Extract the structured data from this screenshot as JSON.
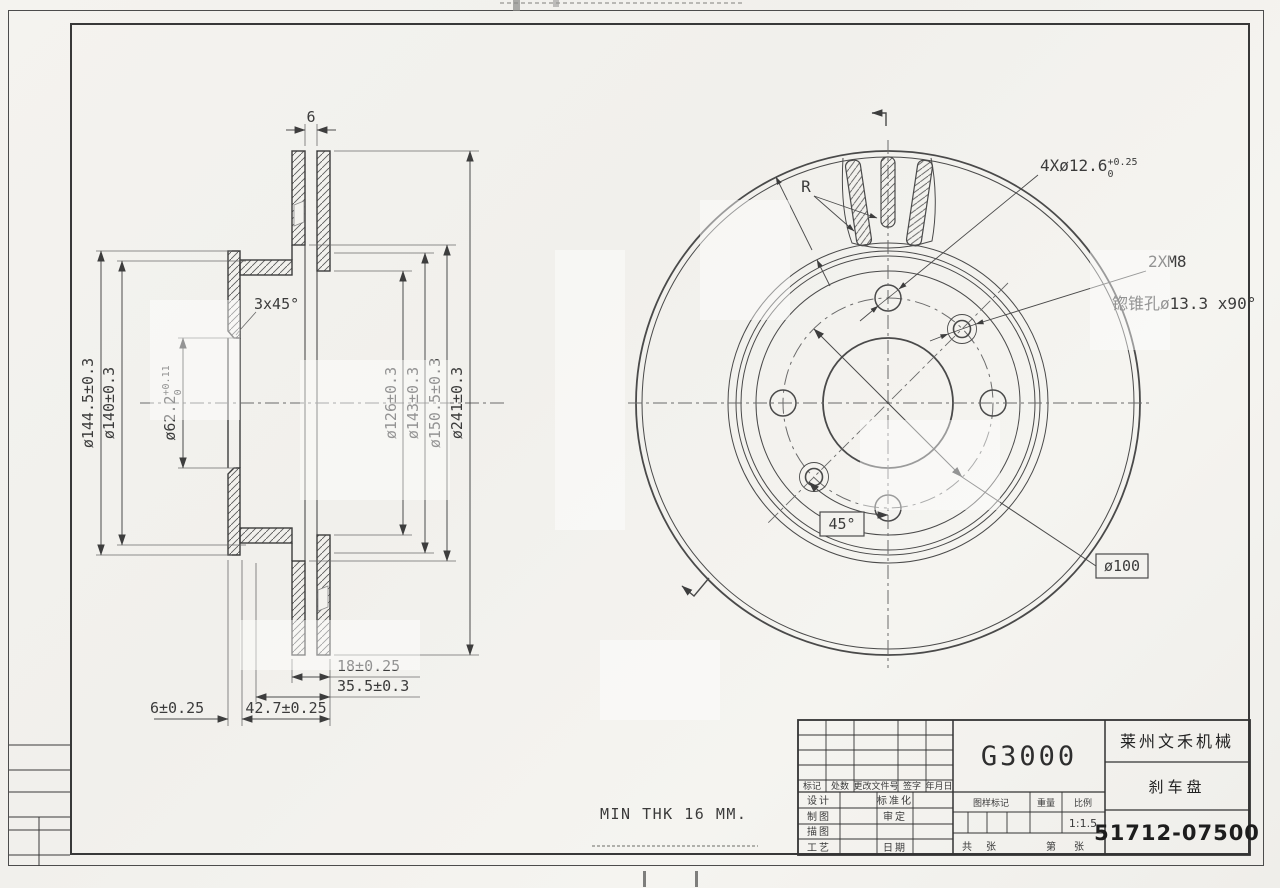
{
  "section_view": {
    "dim_vent": "6",
    "chamfer": "3x45°",
    "d1445": "ø144.5±0.3",
    "d140": "ø140±0.3",
    "d622_main": "ø62.2",
    "d622_sup": "+0.11",
    "d622_sub": "0",
    "d126": "ø126±0.3",
    "d143": "ø143±0.3",
    "d1505": "ø150.5±0.3",
    "d241": "ø241±0.3",
    "d18": "18±0.25",
    "d355": "35.5±0.3",
    "d427": "42.7±0.25",
    "d6": "6±0.25"
  },
  "front_view": {
    "holes_main": "4Xø12.6",
    "holes_sup": "+0.25",
    "holes_sub": "0",
    "thread": "2XM8",
    "countersink": "锪锥孔ø13.3 x90°",
    "bolt_circle": "ø100",
    "angle": "45°",
    "radius_label": "R"
  },
  "notes": {
    "min_thickness": "MIN THK 16 MM."
  },
  "title_block": {
    "material": "G3000",
    "company": "莱州文禾机械",
    "part_name": "刹车盘",
    "part_number": "51712-07500",
    "scale_value": "1:1.5",
    "col_mark": "标记",
    "col_count": "处数",
    "col_doc": "更改文件号",
    "col_sign": "签字",
    "col_date": "年月日",
    "row_design": "设计",
    "row_standard": "标准化",
    "row_draft": "制图",
    "row_approve": "审定",
    "row_trace": "描图",
    "row_process": "工艺",
    "row_date": "日期",
    "lbl_drawing_mark": "图样标记",
    "lbl_weight": "重量",
    "lbl_scale": "比例",
    "lbl_total": "共",
    "lbl_sheet": "张",
    "lbl_no": "第",
    "lbl_sheet2": "张"
  }
}
